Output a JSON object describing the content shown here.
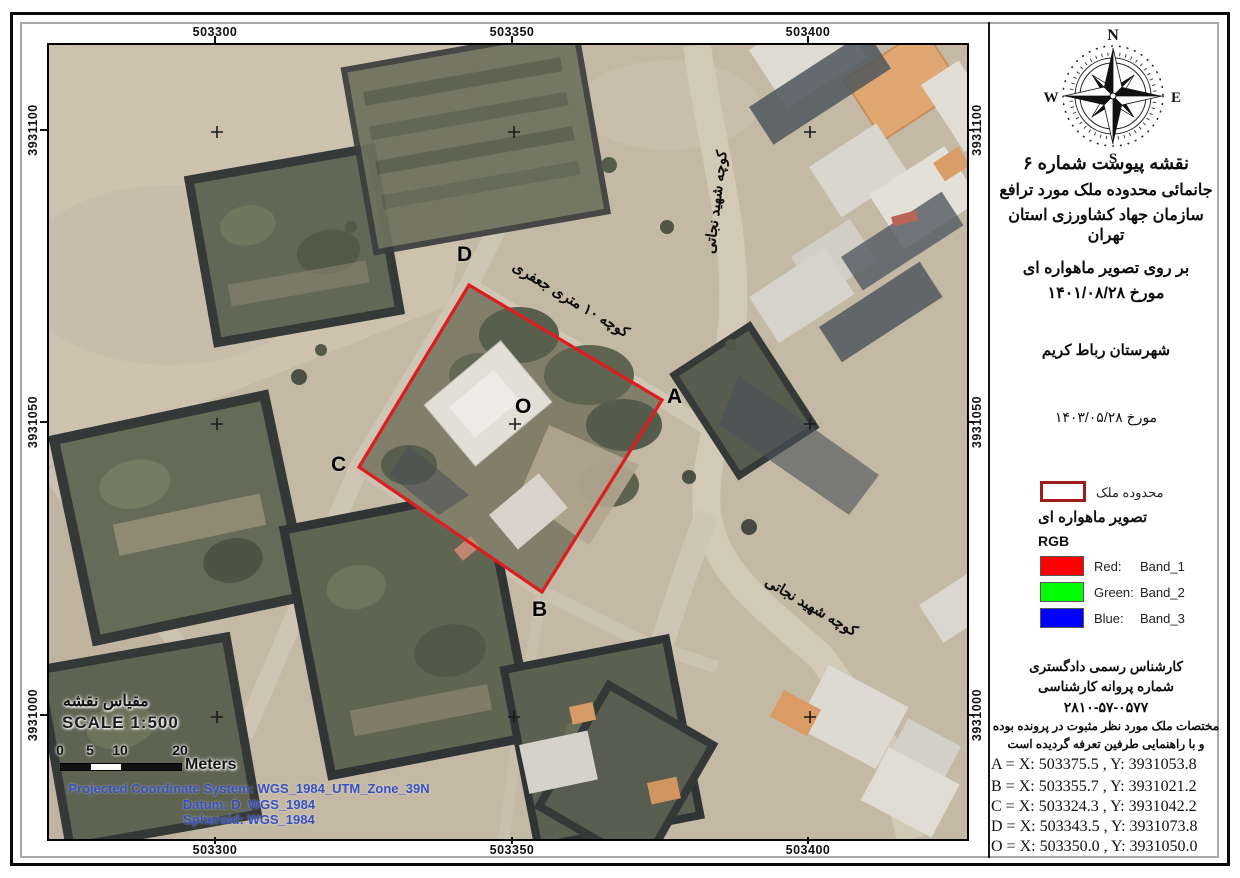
{
  "map": {
    "grid": {
      "top": [
        "503300",
        "503350",
        "503400"
      ],
      "bottom": [
        "503300",
        "503350",
        "503400"
      ],
      "left": [
        "3931100",
        "3931050",
        "3931000"
      ],
      "right": [
        "3931100",
        "3931050",
        "3931000"
      ]
    },
    "points": {
      "A": "A",
      "B": "B",
      "C": "C",
      "D": "D",
      "O": "O"
    },
    "streets": {
      "jafari": "کوچه ۱۰ متری جعفری",
      "nejati_top": "کوچه شهید نجاتی",
      "nejati_bottom": "کوچه شهید نجاتی"
    },
    "scalebar": {
      "label_fa": "مقیاس نقشه",
      "scale_text": "SCALE 1:500",
      "ticks": [
        "0",
        "5",
        "10",
        "20"
      ],
      "unit": "Meters"
    },
    "projection": {
      "line1": "Projected Coordinate System: WGS_1984_UTM_Zone_39N",
      "line2": "Datum: D_WGS_1984",
      "line3": "Spheroid: WGS_1984"
    }
  },
  "sidebar": {
    "compass": {
      "n": "N",
      "e": "E",
      "s": "S",
      "w": "W"
    },
    "title_lines": [
      "نقشه پیوست شماره ۶",
      "جانمائی محدوده ملک مورد ترافع",
      "سازمان جهاد کشاورزی استان تهران",
      "بر روی تصویر ماهواره ای",
      "مورخ ۱۴۰۱/۰۸/۲۸",
      "شهرستان رباط کریم",
      "مورخ ۱۴۰۳/۰۵/۲۸"
    ],
    "legend": {
      "boundary_label": "محدوده ملک",
      "satellite_label": "تصویر ماهواره ای",
      "rgb_label": "RGB",
      "bands": [
        {
          "name": "Red:",
          "band": "Band_1",
          "color": "#ff0000"
        },
        {
          "name": "Green:",
          "band": "Band_2",
          "color": "#00ff00"
        },
        {
          "name": "Blue:",
          "band": "Band_3",
          "color": "#0000ff"
        }
      ]
    },
    "expert_lines": [
      "کارشناس رسمی دادگستری",
      "شماره پروانه کارشناسی",
      "۲۸۱۰-۵۷-۰۵۷۷",
      "مختصات ملک مورد نظر مثبوت در پرونده بوده",
      "و با راهنمایی طرفین تعرفه گردیده است"
    ],
    "coordinates": [
      "A = X: 503375.5 , Y: 3931053.8",
      "B = X: 503355.7 , Y: 3931021.2",
      "C = X: 503324.3 , Y: 3931042.2",
      "D = X: 503343.5 , Y: 3931073.8",
      "O = X: 503350.0 , Y: 3931050.0"
    ]
  },
  "colors": {
    "boundary_red": "#df1d1d",
    "legend_boundary_border": "#9e1c1c",
    "projection_text_blue": "#3650c0",
    "band_red": "#ff0000",
    "band_green": "#00ff00",
    "band_blue": "#0000ff"
  }
}
